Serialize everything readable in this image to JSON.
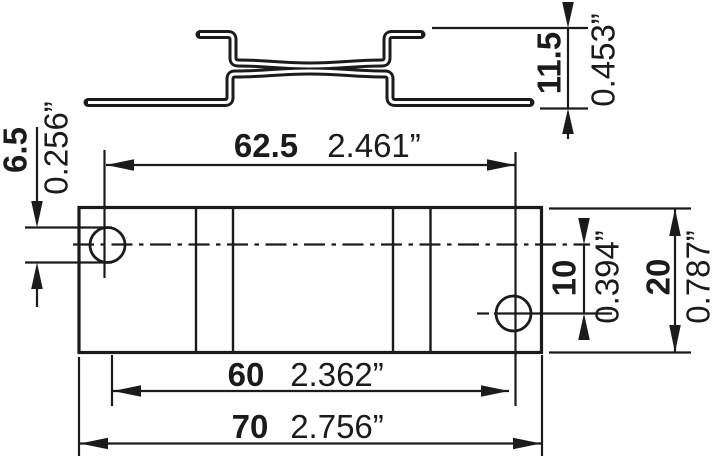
{
  "style": {
    "line_color": "#1b1b1b",
    "background": "#ffffff"
  },
  "dimensions": {
    "profile_height": {
      "mm": "11.5",
      "inch": "0.453”"
    },
    "hole_diameter": {
      "mm": "6.5",
      "inch": "0.256”"
    },
    "hole_pitch_outer": {
      "mm": "62.5",
      "inch": "2.461”"
    },
    "hole_row_offset": {
      "mm": "10",
      "inch": "0.394”"
    },
    "plate_width": {
      "mm": "20",
      "inch": "0.787”"
    },
    "hole_pitch_inner": {
      "mm": "60",
      "inch": "2.362”"
    },
    "plate_length": {
      "mm": "70",
      "inch": "2.756”"
    }
  }
}
